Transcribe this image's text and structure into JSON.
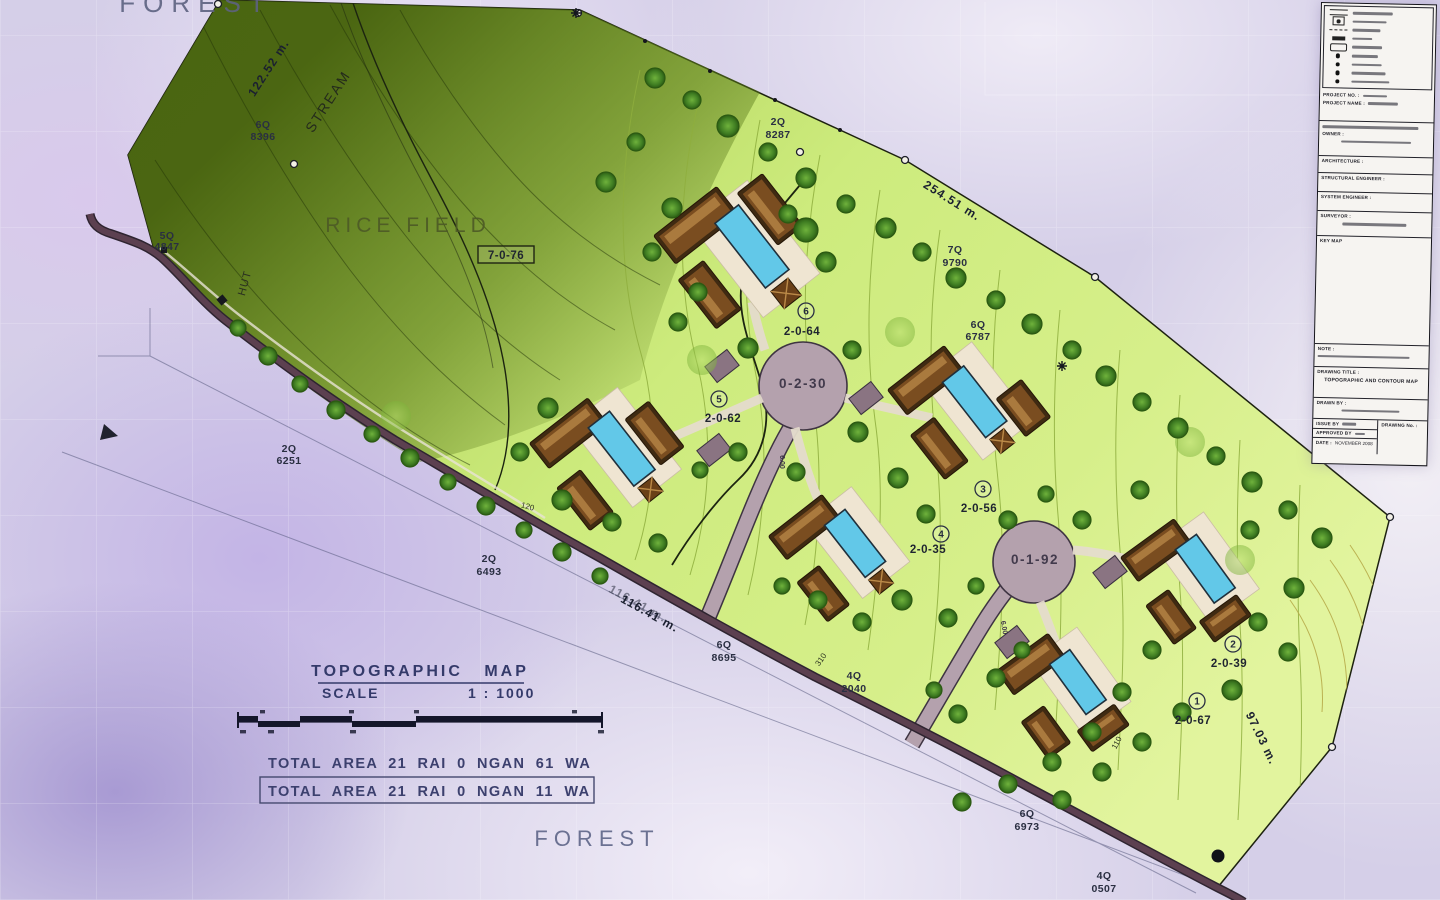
{
  "palette": {
    "paper_lavender": "#d5cfe8",
    "field_green_bright": "#cdeb7d",
    "forest_green_dark": "#5f7d1e",
    "road_dark": "#5c4050",
    "culdesac_grey": "#b4a1ad",
    "pool_blue": "#62c8e8",
    "roof_brown": "#5a3418",
    "tree_green": "#3f7d22",
    "ink_indigo": "#3a3e6e"
  },
  "map": {
    "labels": {
      "forest_top": "FOREST",
      "rice_field": "RICE FIELD",
      "stream": "STREAM",
      "hut": "HUT",
      "forest_bottom": "FOREST"
    },
    "rice_field_area": "7-0-76",
    "dims": {
      "west": "122.52 m.",
      "north": "254.51 m.",
      "south": "116.41 m.",
      "southeast": "97.03 m."
    },
    "markers": [
      {
        "code": "5Q",
        "num": "4847"
      },
      {
        "code": "6Q",
        "num": "8396"
      },
      {
        "code": "2Q",
        "num": "8287"
      },
      {
        "code": "7Q",
        "num": "9790"
      },
      {
        "code": "6Q",
        "num": "6787"
      },
      {
        "code": "2Q",
        "num": "6251"
      },
      {
        "code": "2Q",
        "num": "6493"
      },
      {
        "code": "6Q",
        "num": "8695"
      },
      {
        "code": "4Q",
        "num": "2040"
      },
      {
        "code": "6Q",
        "num": "6973"
      },
      {
        "code": "4Q",
        "num": "0507"
      }
    ],
    "plots": [
      {
        "no": "1",
        "area": "2-0-67"
      },
      {
        "no": "2",
        "area": "2-0-39"
      },
      {
        "no": "3",
        "area": "2-0-56"
      },
      {
        "no": "4",
        "area": "2-0-35"
      },
      {
        "no": "5",
        "area": "2-0-62"
      },
      {
        "no": "6",
        "area": "2-0-64"
      }
    ],
    "roads": {
      "culdesac_a": "0-2-30",
      "culdesac_b": "0-1-92",
      "width_a": "6.00",
      "width_b": "6.00"
    },
    "contour_labels": {
      "c120": "120",
      "c310": "310",
      "c110": "110"
    }
  },
  "footer": {
    "title": "TOPOGRAPHIC MAP",
    "scale_label": "SCALE",
    "scale_value": "1 : 1000",
    "total_area_line1": "TOTAL AREA 21 RAI 0 NGAN 61 WA",
    "total_area_line2": "TOTAL AREA 21 RAI 0 NGAN 11 WA"
  },
  "title_block": {
    "project_no_label": "PROJECT NO. :",
    "project_name_label": "PROJECT NAME :",
    "owner_label": "OWNER :",
    "architecture_label": "ARCHITECTURE :",
    "structural_label": "STRUCTURAL ENGINEER :",
    "system_label": "SYSTEM ENGINEER :",
    "surveyor_label": "SURVEYOR :",
    "key_map_label": "KEY MAP",
    "note_label": "NOTE :",
    "drawing_title_label": "DRAWING TITLE :",
    "drawing_title_value": "TOPOGRAPHIC AND CONTOUR MAP",
    "drawn_by_label": "DRAWN BY :",
    "issue_by_label": "ISSUE BY",
    "approved_by_label": "APPROVED BY",
    "date_label": "DATE :",
    "date_value": "NOVEMBER 2008",
    "drawing_no_label": "DRAWING No. :"
  }
}
